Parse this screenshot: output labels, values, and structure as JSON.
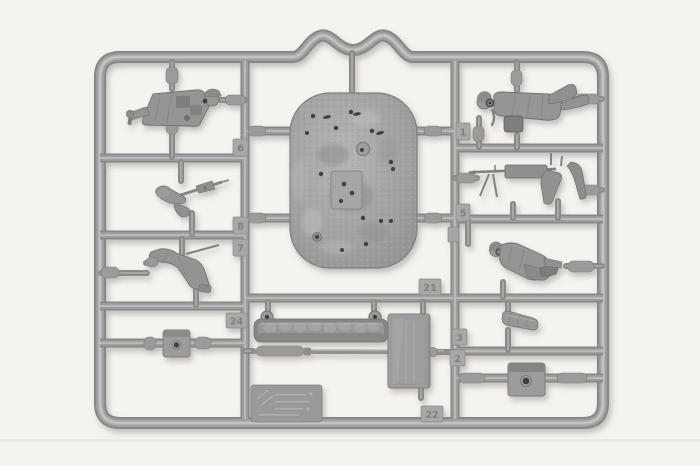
{
  "image": {
    "alt": "Photograph of a grey injection-moulded plastic model kit sprue containing small soldier figures, a machine gun, a rifle arm, a large textured base plate with holes, a track section, a rod, hatch squares, a door plate and an embossed marking plate, all attached to a rectangular runner frame with a wavy crown at the top centre.",
    "background_color": "#f5f3f0",
    "plastic_color": "#9a9a9a",
    "plastic_highlight": "#c6c6c6",
    "plastic_shadow": "#757575",
    "hole_color": "#3e3e3e",
    "tag_number_color": "#7c7c7c"
  },
  "tags": {
    "items": [
      {
        "label": "6"
      },
      {
        "label": "8"
      },
      {
        "label": "7"
      },
      {
        "label": "1"
      },
      {
        "label": "5"
      },
      {
        "label": "21"
      },
      {
        "label": "24"
      },
      {
        "label": "3"
      },
      {
        "label": "2"
      },
      {
        "label": "22"
      }
    ]
  },
  "parts": {
    "names": [
      "officer figure",
      "arm with rifle",
      "kneeling figure",
      "left hatch square",
      "textured base plate",
      "track section",
      "thin rod",
      "door plate",
      "embossed marking plate",
      "prone figure",
      "machine gun",
      "sitting figure",
      "bedroll",
      "right hatch square"
    ]
  }
}
